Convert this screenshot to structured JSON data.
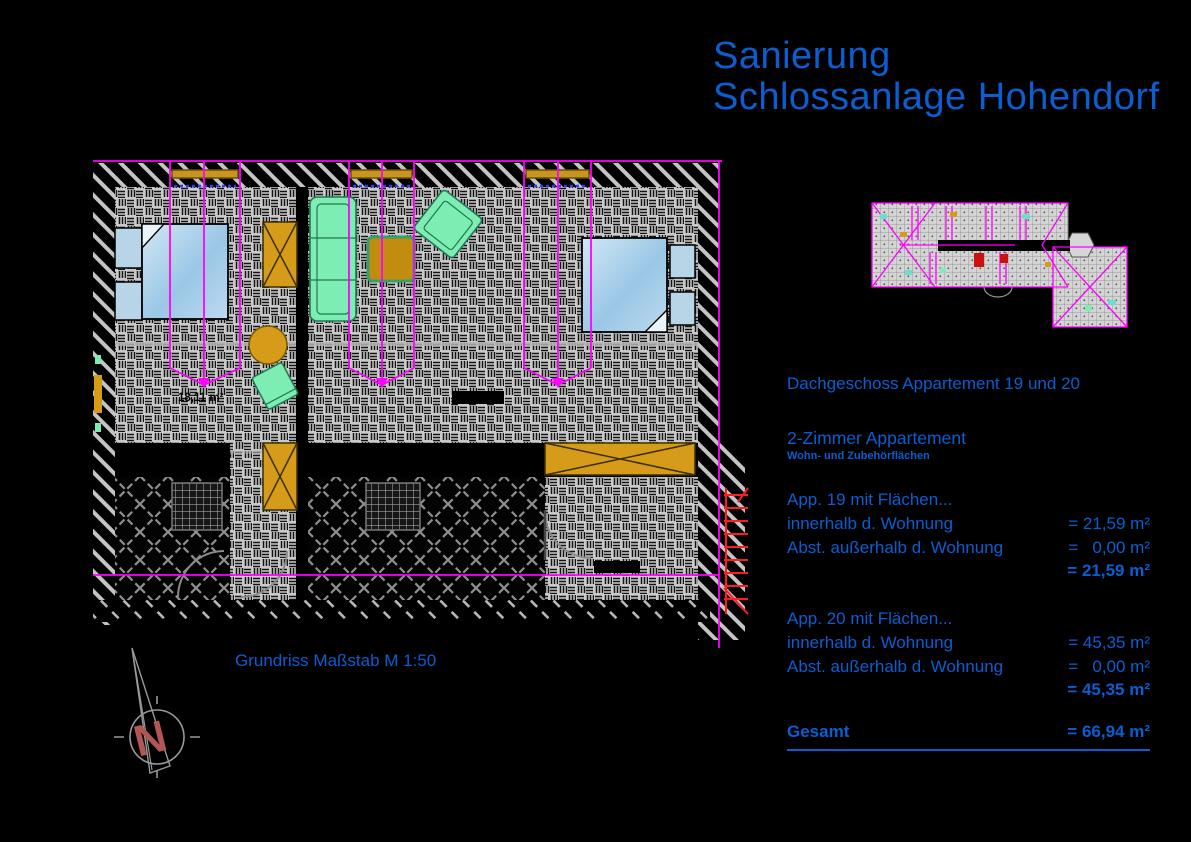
{
  "title": {
    "line1": "Sanierung",
    "line2": "Schlossanlage Hohendorf"
  },
  "colors": {
    "accent_blue": "#0a5ed2",
    "magenta": "#ff00ff",
    "furniture_orange": "#d79b1a",
    "furniture_green": "#7dedb4",
    "bed_blue": "#aed4ec",
    "stair_red": "#ff1c1c"
  },
  "info": {
    "heading": "Dachgeschoss Appartement 19 und 20",
    "subheading": "2-Zimmer Appartement",
    "subnote": "Wohn- und Zubehörflächen",
    "blocks": [
      {
        "title": "App. 19 mit Flächen...",
        "rows": [
          {
            "label": "innerhalb d. Wohnung",
            "value": "= 21,59 m²"
          },
          {
            "label": "Abst. außerhalb d. Wohnung",
            "value": "=   0,00 m²"
          }
        ],
        "total": "= 21,59 m²"
      },
      {
        "title": "App. 20 mit Flächen...",
        "rows": [
          {
            "label": "innerhalb d. Wohnung",
            "value": "= 45,35 m²"
          },
          {
            "label": "Abst. außerhalb d. Wohnung",
            "value": "=   0,00 m²"
          }
        ],
        "total": "= 45,35 m²"
      }
    ],
    "gesamt_label": "Gesamt",
    "gesamt_value": "= 66,94 m²"
  },
  "plan": {
    "caption": "Grundriss Maßstab M 1:50",
    "room_area_label": "18,11 m²",
    "north_letter": "N"
  }
}
